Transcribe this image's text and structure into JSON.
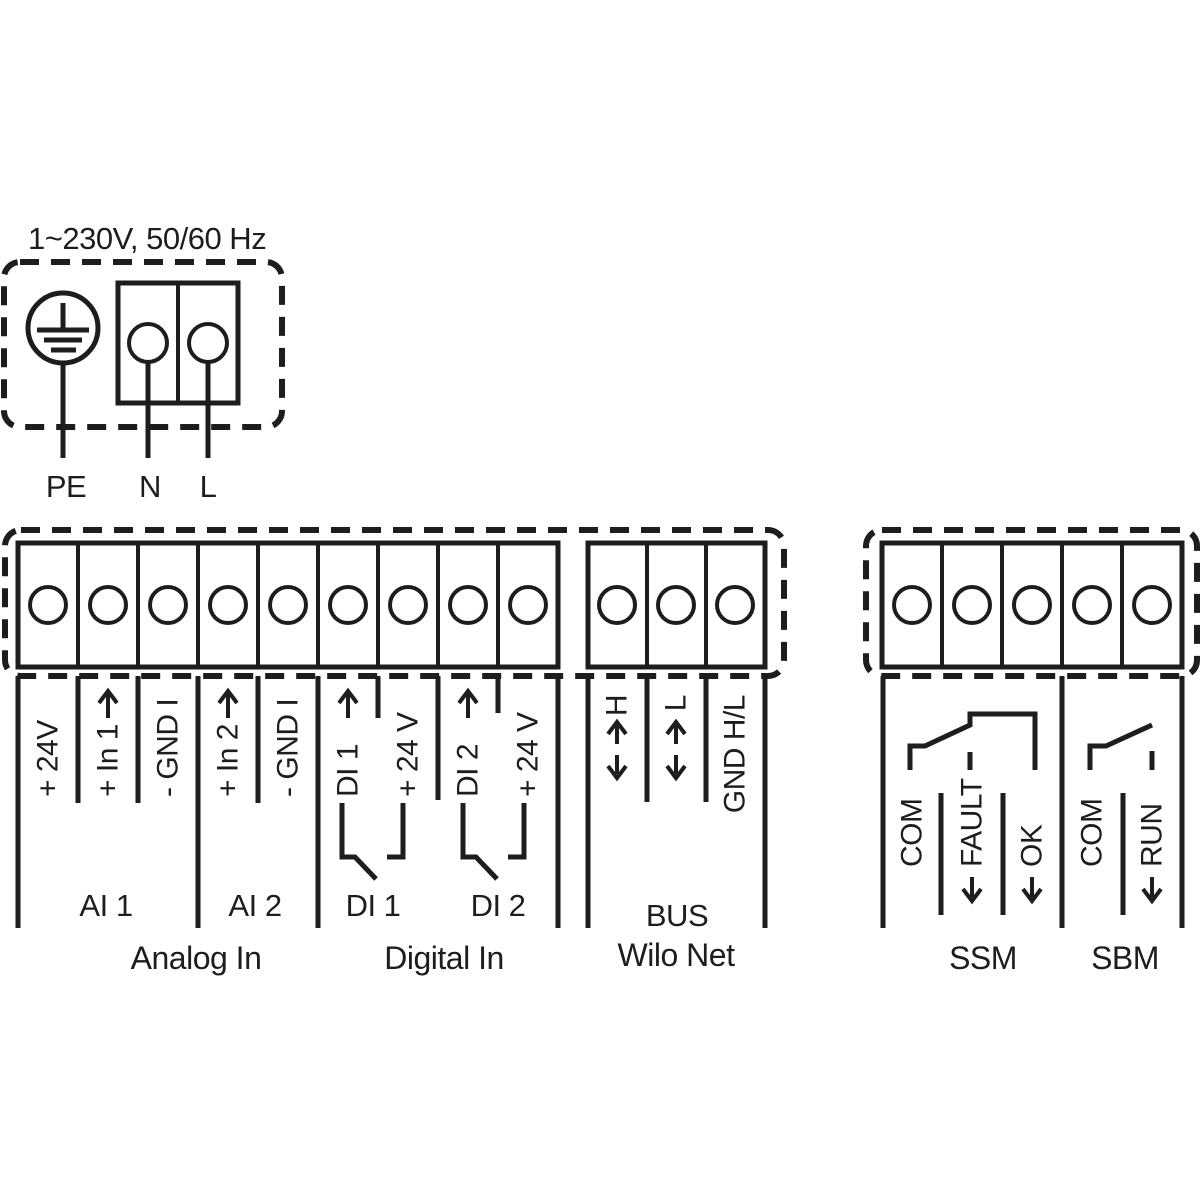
{
  "power": {
    "title": "1~230V, 50/60 Hz",
    "terminals": [
      "PE",
      "N",
      "L"
    ]
  },
  "io_strip": {
    "analog": {
      "terminals": [
        {
          "label": "+ 24V",
          "arrow": "none"
        },
        {
          "label": "+ In 1",
          "arrow": "up"
        },
        {
          "label": "- GND I",
          "arrow": "none"
        },
        {
          "label": "+ In 2",
          "arrow": "up"
        },
        {
          "label": "- GND I",
          "arrow": "none"
        }
      ],
      "groups": [
        "AI 1",
        "AI 2"
      ],
      "section_label": "Analog In"
    },
    "digital": {
      "terminals": [
        {
          "label": "DI 1",
          "arrow": "up"
        },
        {
          "label": "+ 24 V",
          "arrow": "none"
        },
        {
          "label": "DI 2",
          "arrow": "up"
        },
        {
          "label": "+ 24 V",
          "arrow": "none"
        }
      ],
      "groups": [
        "DI 1",
        "DI 2"
      ],
      "section_label": "Digital In"
    },
    "bus": {
      "terminals": [
        {
          "label": "H",
          "arrow": "updown"
        },
        {
          "label": "L",
          "arrow": "updown"
        },
        {
          "label": "GND H/L",
          "arrow": "none"
        }
      ],
      "group": "BUS",
      "section_label": "Wilo Net"
    }
  },
  "relay_strip": {
    "ssm": {
      "terminals": [
        {
          "label": "COM",
          "arrow": "none"
        },
        {
          "label": "FAULT",
          "arrow": "down"
        },
        {
          "label": "OK",
          "arrow": "down"
        }
      ],
      "section_label": "SSM"
    },
    "sbm": {
      "terminals": [
        {
          "label": "COM",
          "arrow": "none"
        },
        {
          "label": "RUN",
          "arrow": "down"
        }
      ],
      "section_label": "SBM"
    }
  },
  "colors": {
    "line": "#1d1d1b",
    "background": "#ffffff"
  }
}
